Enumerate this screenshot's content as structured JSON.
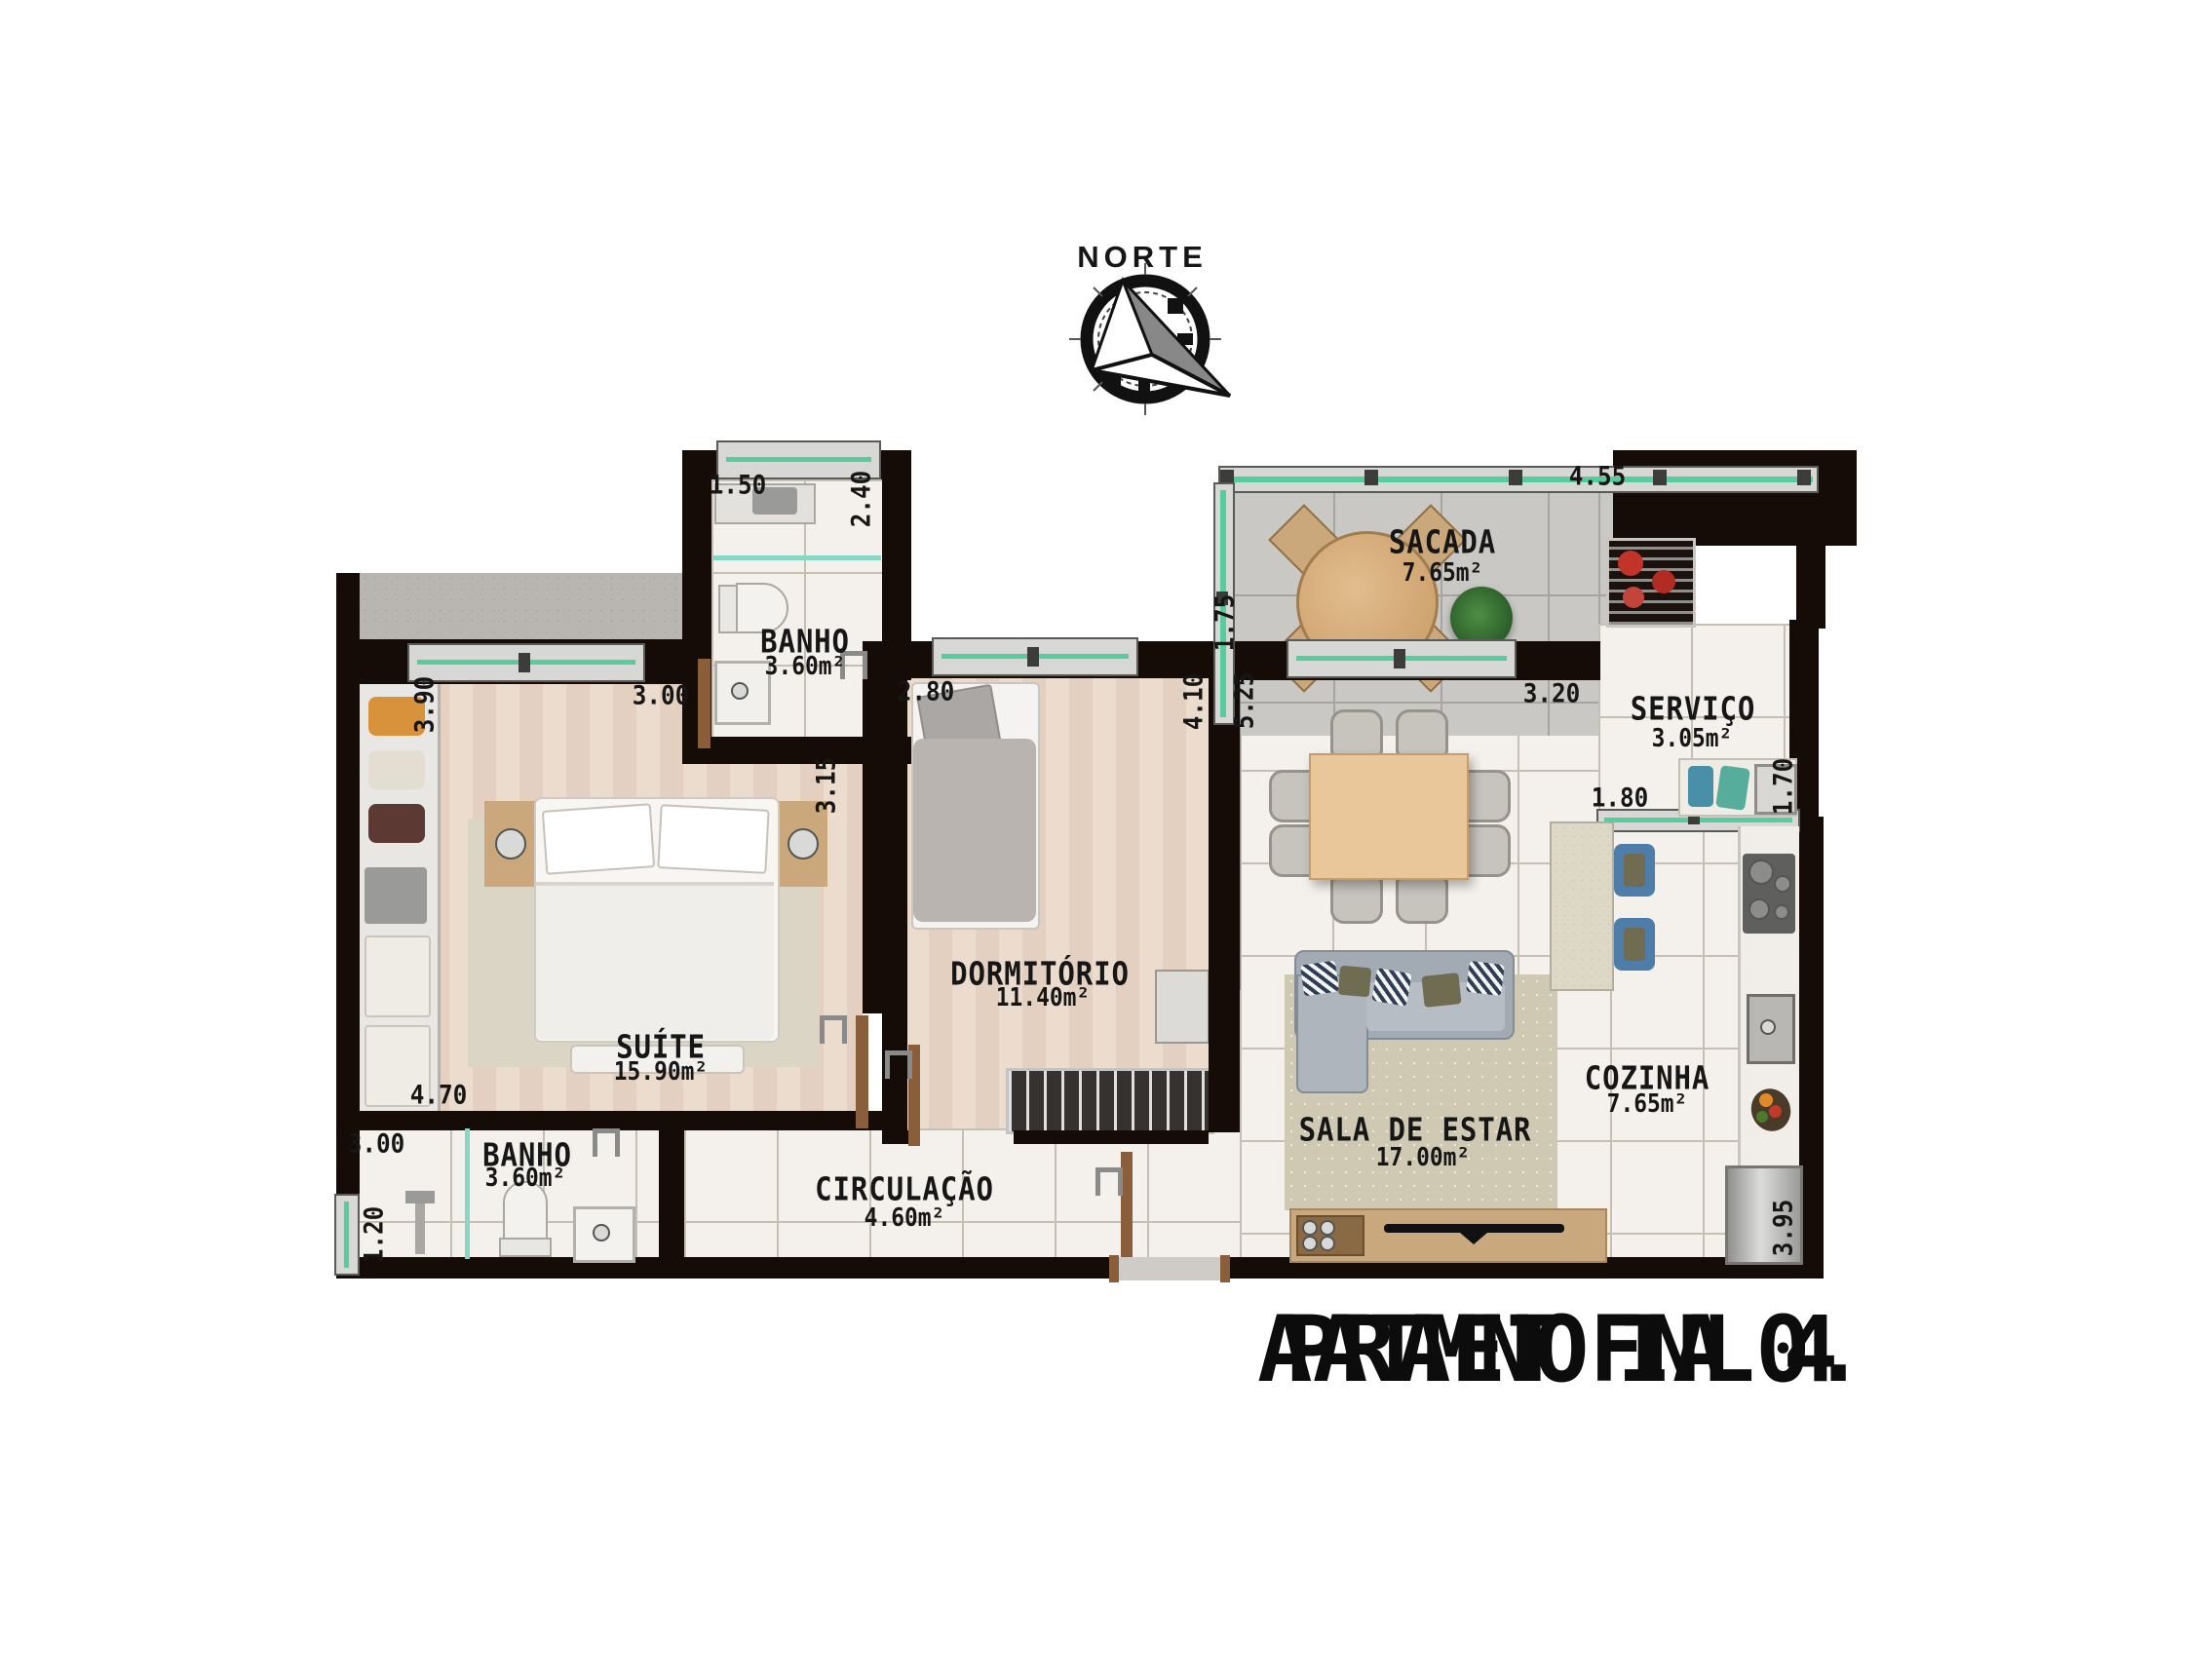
{
  "compass": {
    "label": "NORTE"
  },
  "title": {
    "text": "APARTAMENTO FINAL 04."
  },
  "rooms": {
    "sacada": {
      "name": "SACADA",
      "area": "7.65m²"
    },
    "servico": {
      "name": "SERVIÇO",
      "area": "3.05m²"
    },
    "banho_suite": {
      "name": "BANHO",
      "area": "3.60m²"
    },
    "suite": {
      "name": "SUÍTE",
      "area": "15.90m²"
    },
    "dormitorio": {
      "name": "DORMITÓRIO",
      "area": "11.40m²"
    },
    "cozinha": {
      "name": "COZINHA",
      "area": "7.65m²"
    },
    "sala": {
      "name": "SALA DE ESTAR",
      "area": "17.00m²"
    },
    "circulacao": {
      "name": "CIRCULAÇÃO",
      "area": "4.60m²"
    },
    "banho_social": {
      "name": "BANHO",
      "area": "3.60m²"
    }
  },
  "dims": {
    "banho_suite_w": "1.50",
    "banho_suite_h": "2.40",
    "suite_left": "3.90",
    "suite_top": "3.00",
    "suite_right": "3.15",
    "suite_bottom": "4.70",
    "dorm_top": "2.80",
    "dorm_right": "4.10",
    "sala_left": "5.25",
    "sala_top": "3.20",
    "sacada_top": "4.55",
    "sacada_left": "1.75",
    "servico_w": "1.80",
    "servico_h": "1.70",
    "banho_social_w": "3.00",
    "banho_social_h": "1.20",
    "cozinha_right": "3.95"
  },
  "colors": {
    "wall": "#150c08",
    "window_glass": "#57cd9e",
    "wood_floor": "#e8d7c8",
    "tile_floor": "#f4f1ec",
    "balcony_tile": "#c9c8c5",
    "door": "#8a5d3b"
  }
}
